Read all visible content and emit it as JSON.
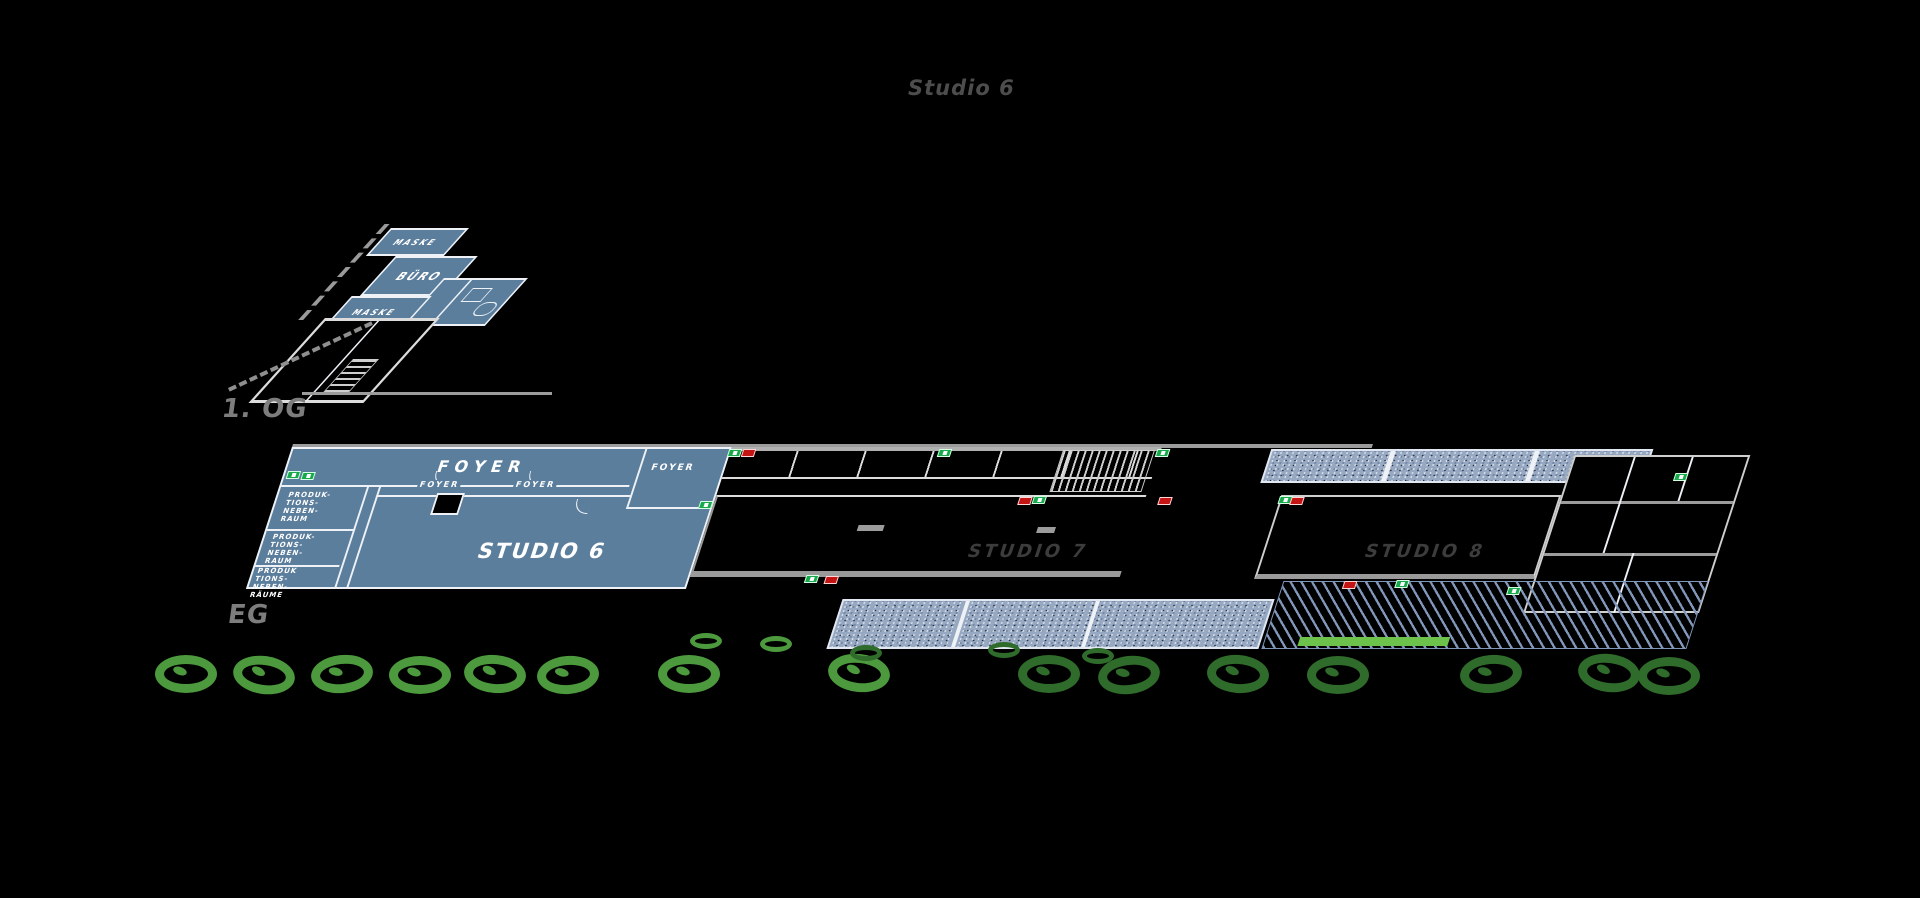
{
  "title": "Studio 6",
  "floors": {
    "og": {
      "label": "1. OG",
      "rooms": {
        "maske1": "MASKE",
        "buero": "BÜRO",
        "maske2": "MASKE"
      }
    },
    "eg": {
      "label": "EG",
      "rooms": {
        "foyer_main": "FOYER",
        "foyer_small_1": "FOYER",
        "foyer_small_2": "FOYER",
        "foyer_right": "FOYER",
        "produktionsnebenraum_1": "PRODUK-\nTIONS-\nNEBEN-\nRAUM",
        "produktionsnebenraum_2": "PRODUK-\nTIONS-\nNEBEN-\nRAUM",
        "produktionsnebenraeume": "PRODUK\nTIONS-\nNEBEN-\nRÄUME",
        "studio6": "STUDIO 6",
        "studio7": "STUDIO 7",
        "studio8": "STUDIO 8"
      }
    }
  },
  "colors": {
    "highlight_blue": "#5b7e9d",
    "terrace_stipple": "#97a9c2",
    "tree_light_green": "#4c9a3d",
    "tree_dark_green": "#2f6b2a",
    "lawn_green": "#6cc24a",
    "exit_green": "#18a94d",
    "door_red": "#c51414"
  }
}
